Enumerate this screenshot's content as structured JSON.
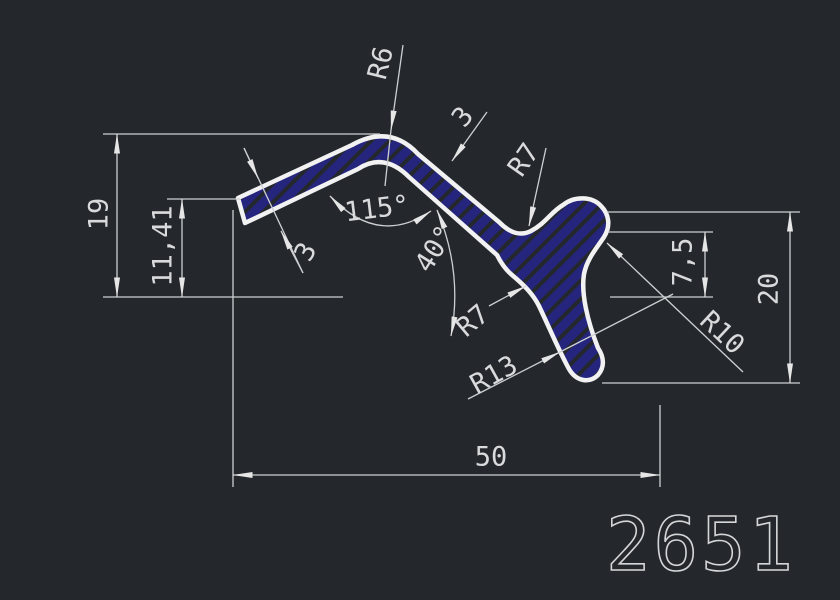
{
  "drawing": {
    "part_number": "2651",
    "dimensions": {
      "overall_height": "19",
      "left_end_height": "11,41",
      "overall_width": "50",
      "head_top_offset": "7,5",
      "head_height": "20",
      "bend_angle": "115°",
      "leg_angle": "40°",
      "wall_thickness_left": "3",
      "wall_thickness_right": "3",
      "bend_radius": "R6",
      "top_fillet_radius": "R7",
      "bottom_fillet_radius": "R7",
      "tail_fillet_radius": "R13",
      "head_radius": "R10"
    },
    "colors": {
      "background": "#24282d",
      "outline": "#f2f2f2",
      "dimension_lines": "#cdd0d2",
      "hatch": "#25257e"
    }
  }
}
